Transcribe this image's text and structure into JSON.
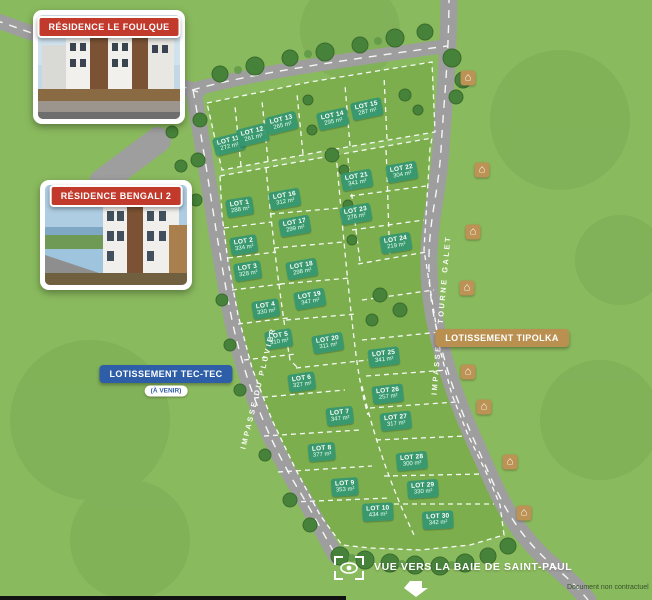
{
  "photos": {
    "foulque": {
      "title": "RÉSIDENCE LE FOULQUE"
    },
    "bengali": {
      "title": "RÉSIDENCE BENGALI 2"
    }
  },
  "banners": {
    "tec_tec": {
      "label": "LOTISSEMENT TEC-TEC",
      "sub": "(À VENIR)"
    },
    "tipolka": {
      "label": "LOTISSEMENT TIPOLKA"
    }
  },
  "streets": {
    "pluvier": "IMPASSE DU PLUVIER",
    "tourne_galet": "IMPASSE TI TOURNE GALET"
  },
  "view_callout": {
    "label": "VUE VERS LA BAIE DE SAINT-PAUL"
  },
  "footnote": "Document non contractuel",
  "icons": {
    "house": "⌂"
  },
  "colors": {
    "grass": "#8aba5e",
    "parcel": "#7cae4d",
    "road": "#9e9e9e",
    "lot_label": "#349771",
    "red_banner": "#c13a2c",
    "blue_banner": "#2f5ea8",
    "tan_banner": "#b9904f",
    "tree": "#47823a"
  },
  "lots": [
    {
      "num": "LOT 1",
      "area": "288 m²"
    },
    {
      "num": "LOT 2",
      "area": "334 m²"
    },
    {
      "num": "LOT 3",
      "area": "328 m²"
    },
    {
      "num": "LOT 4",
      "area": "330 m²"
    },
    {
      "num": "LOT 5",
      "area": "310 m²"
    },
    {
      "num": "LOT 6",
      "area": "327 m²"
    },
    {
      "num": "LOT 7",
      "area": "347 m²"
    },
    {
      "num": "LOT 8",
      "area": "377 m²"
    },
    {
      "num": "LOT 9",
      "area": "353 m²"
    },
    {
      "num": "LOT 10",
      "area": "434 m²"
    },
    {
      "num": "LOT 11",
      "area": "272 m²"
    },
    {
      "num": "LOT 12",
      "area": "261 m²"
    },
    {
      "num": "LOT 13",
      "area": "265 m²"
    },
    {
      "num": "LOT 14",
      "area": "295 m²"
    },
    {
      "num": "LOT 15",
      "area": "287 m²"
    },
    {
      "num": "LOT 16",
      "area": "312 m²"
    },
    {
      "num": "LOT 17",
      "area": "299 m²"
    },
    {
      "num": "LOT 18",
      "area": "298 m²"
    },
    {
      "num": "LOT 19",
      "area": "347 m²"
    },
    {
      "num": "LOT 20",
      "area": "311 m²"
    },
    {
      "num": "LOT 21",
      "area": "341 m²"
    },
    {
      "num": "LOT 22",
      "area": "304 m²"
    },
    {
      "num": "LOT 23",
      "area": "276 m²"
    },
    {
      "num": "LOT 24",
      "area": "219 m²"
    },
    {
      "num": "LOT 25",
      "area": "341 m²"
    },
    {
      "num": "LOT 26",
      "area": "257 m²"
    },
    {
      "num": "LOT 27",
      "area": "317 m²"
    },
    {
      "num": "LOT 28",
      "area": "300 m²"
    },
    {
      "num": "LOT 29",
      "area": "330 m²"
    },
    {
      "num": "LOT 30",
      "area": "342 m²"
    }
  ]
}
